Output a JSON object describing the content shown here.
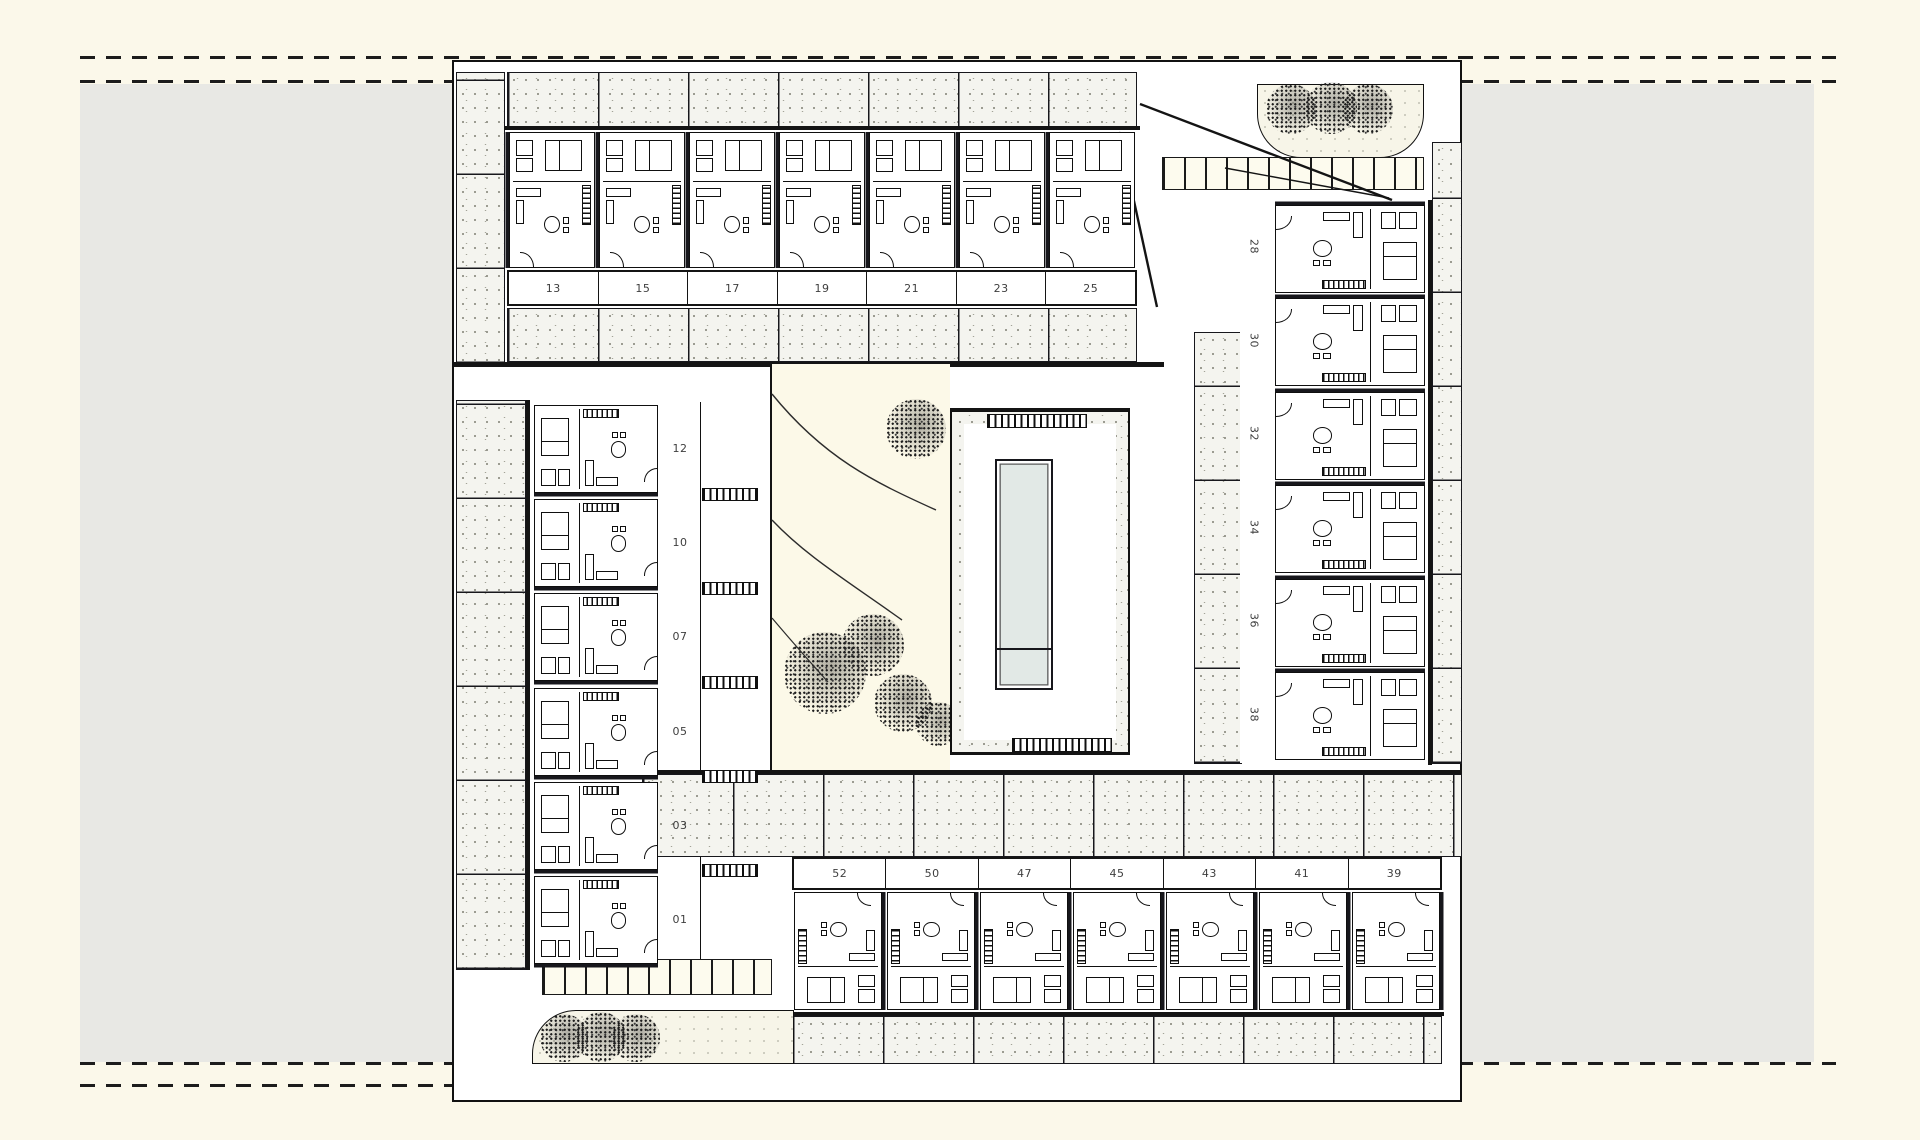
{
  "drawing": {
    "kind": "residential-site-plan",
    "unit_numbers": {
      "top_row": [
        "13",
        "15",
        "17",
        "19",
        "21",
        "23",
        "25"
      ],
      "right_column": [
        "28",
        "30",
        "32",
        "34",
        "36",
        "38"
      ],
      "left_column": [
        "12",
        "10",
        "07",
        "05",
        "03",
        "01"
      ],
      "bottom_row": [
        "52",
        "50",
        "47",
        "45",
        "43",
        "41",
        "39"
      ]
    },
    "features": {
      "pool": "rectangular lap pool",
      "trees_top_right": 3,
      "trees_bottom_left": 3,
      "courtyard_trees": 5,
      "parking_strips": 2
    }
  },
  "colors": {
    "canvas": "#fbf8ea",
    "neighbour_grey": "#e8e8e4",
    "paving_speckle": "#f4f4ef",
    "linework": "#141414",
    "pool_water": "#e2e9e6",
    "garden": "#fcf9e8"
  }
}
